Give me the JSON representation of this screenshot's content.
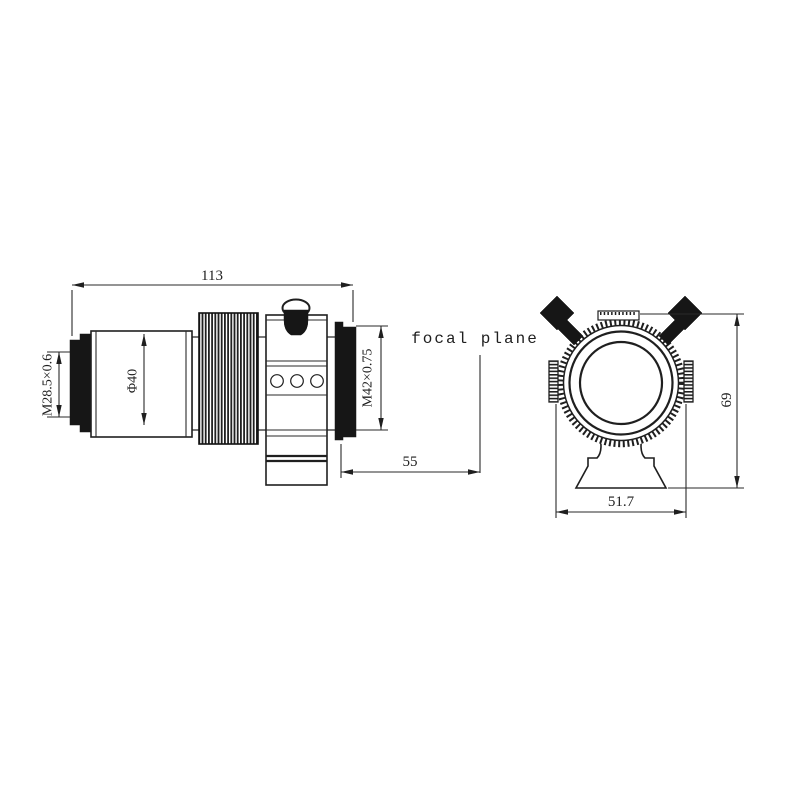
{
  "figure": {
    "type": "technical-drawing",
    "background": "#ffffff",
    "line_color": "#1f1f1f",
    "side_view": {
      "name": "guide-scope side view",
      "dims": {
        "overall_length": "113",
        "front_thread": "M28.5×0.6",
        "tube_diameter": "Φ40",
        "rear_thread": "M42×0.75",
        "back_focus": "55"
      },
      "focal_plane_label": "focal plane"
    },
    "front_view": {
      "name": "mounting-ring front view",
      "dims": {
        "overall_height": "69",
        "ring_width": "51.7"
      }
    }
  }
}
